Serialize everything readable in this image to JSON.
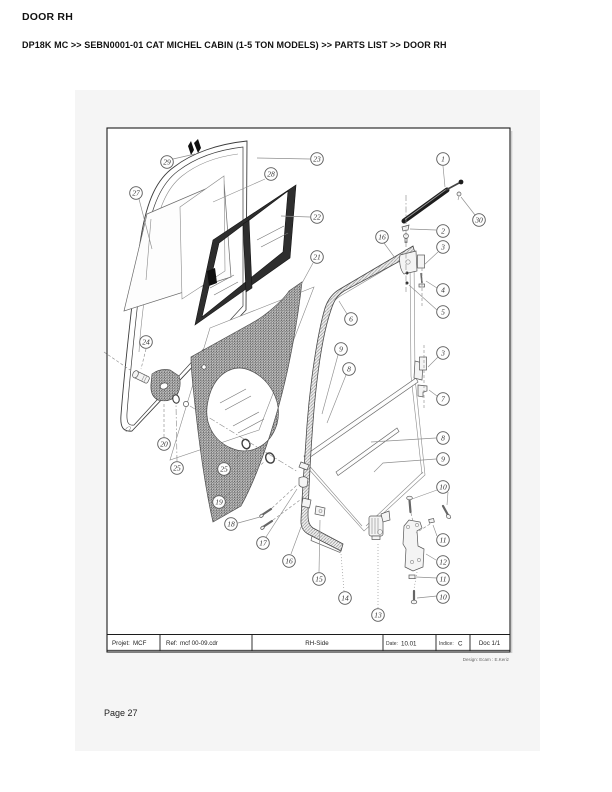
{
  "header": {
    "title": "DOOR RH",
    "breadcrumb": "DP18K MC >> SEBN0001-01 CAT MICHEL CABIN (1-5 TON MODELS) >> PARTS LIST >> DOOR RH"
  },
  "footer": {
    "page_label": "Page 27"
  },
  "drawing": {
    "title_block": {
      "project_label": "Projet:",
      "project_value": "MCF",
      "ref_label": "Ref:",
      "ref_value": "mcf 00-09.cdr",
      "view": "RH-Side",
      "date_label": "Date:",
      "date_value": "10.01",
      "indice_label": "Indice:",
      "indice_value": "C",
      "doc": "Doc 1/1"
    },
    "credit": "Design: Ecam : E.Keriz",
    "callouts": [
      {
        "n": "1",
        "x": 443,
        "y": 159
      },
      {
        "n": "30",
        "x": 479,
        "y": 220
      },
      {
        "n": "2",
        "x": 443,
        "y": 231
      },
      {
        "n": "16",
        "x": 382,
        "y": 237
      },
      {
        "n": "3",
        "x": 443,
        "y": 247
      },
      {
        "n": "4",
        "x": 443,
        "y": 290
      },
      {
        "n": "5",
        "x": 443,
        "y": 312
      },
      {
        "n": "6",
        "x": 351,
        "y": 319
      },
      {
        "n": "3",
        "x": 443,
        "y": 353
      },
      {
        "n": "7",
        "x": 443,
        "y": 399
      },
      {
        "n": "9",
        "x": 341,
        "y": 349
      },
      {
        "n": "8",
        "x": 349,
        "y": 369
      },
      {
        "n": "8",
        "x": 443,
        "y": 438
      },
      {
        "n": "9",
        "x": 443,
        "y": 459
      },
      {
        "n": "10",
        "x": 443,
        "y": 487
      },
      {
        "n": "11",
        "x": 443,
        "y": 540
      },
      {
        "n": "12",
        "x": 443,
        "y": 562
      },
      {
        "n": "11",
        "x": 443,
        "y": 579
      },
      {
        "n": "10",
        "x": 443,
        "y": 597
      },
      {
        "n": "13",
        "x": 378,
        "y": 615
      },
      {
        "n": "14",
        "x": 345,
        "y": 598
      },
      {
        "n": "15",
        "x": 319,
        "y": 579
      },
      {
        "n": "16",
        "x": 289,
        "y": 561
      },
      {
        "n": "17",
        "x": 263,
        "y": 543
      },
      {
        "n": "18",
        "x": 231,
        "y": 524
      },
      {
        "n": "19",
        "x": 219,
        "y": 502
      },
      {
        "n": "25",
        "x": 224,
        "y": 469
      },
      {
        "n": "25",
        "x": 177,
        "y": 468
      },
      {
        "n": "20",
        "x": 164,
        "y": 444
      },
      {
        "n": "24",
        "x": 146,
        "y": 342
      },
      {
        "n": "21",
        "x": 317,
        "y": 257
      },
      {
        "n": "22",
        "x": 317,
        "y": 217
      },
      {
        "n": "23",
        "x": 317,
        "y": 159
      },
      {
        "n": "28",
        "x": 271,
        "y": 174
      },
      {
        "n": "27",
        "x": 136,
        "y": 193
      },
      {
        "n": "29",
        "x": 167,
        "y": 162
      }
    ]
  },
  "colors": {
    "page_panel": "#f5f5f5",
    "line": "#3c3c3c",
    "dark_part": "#2e2e2e"
  }
}
